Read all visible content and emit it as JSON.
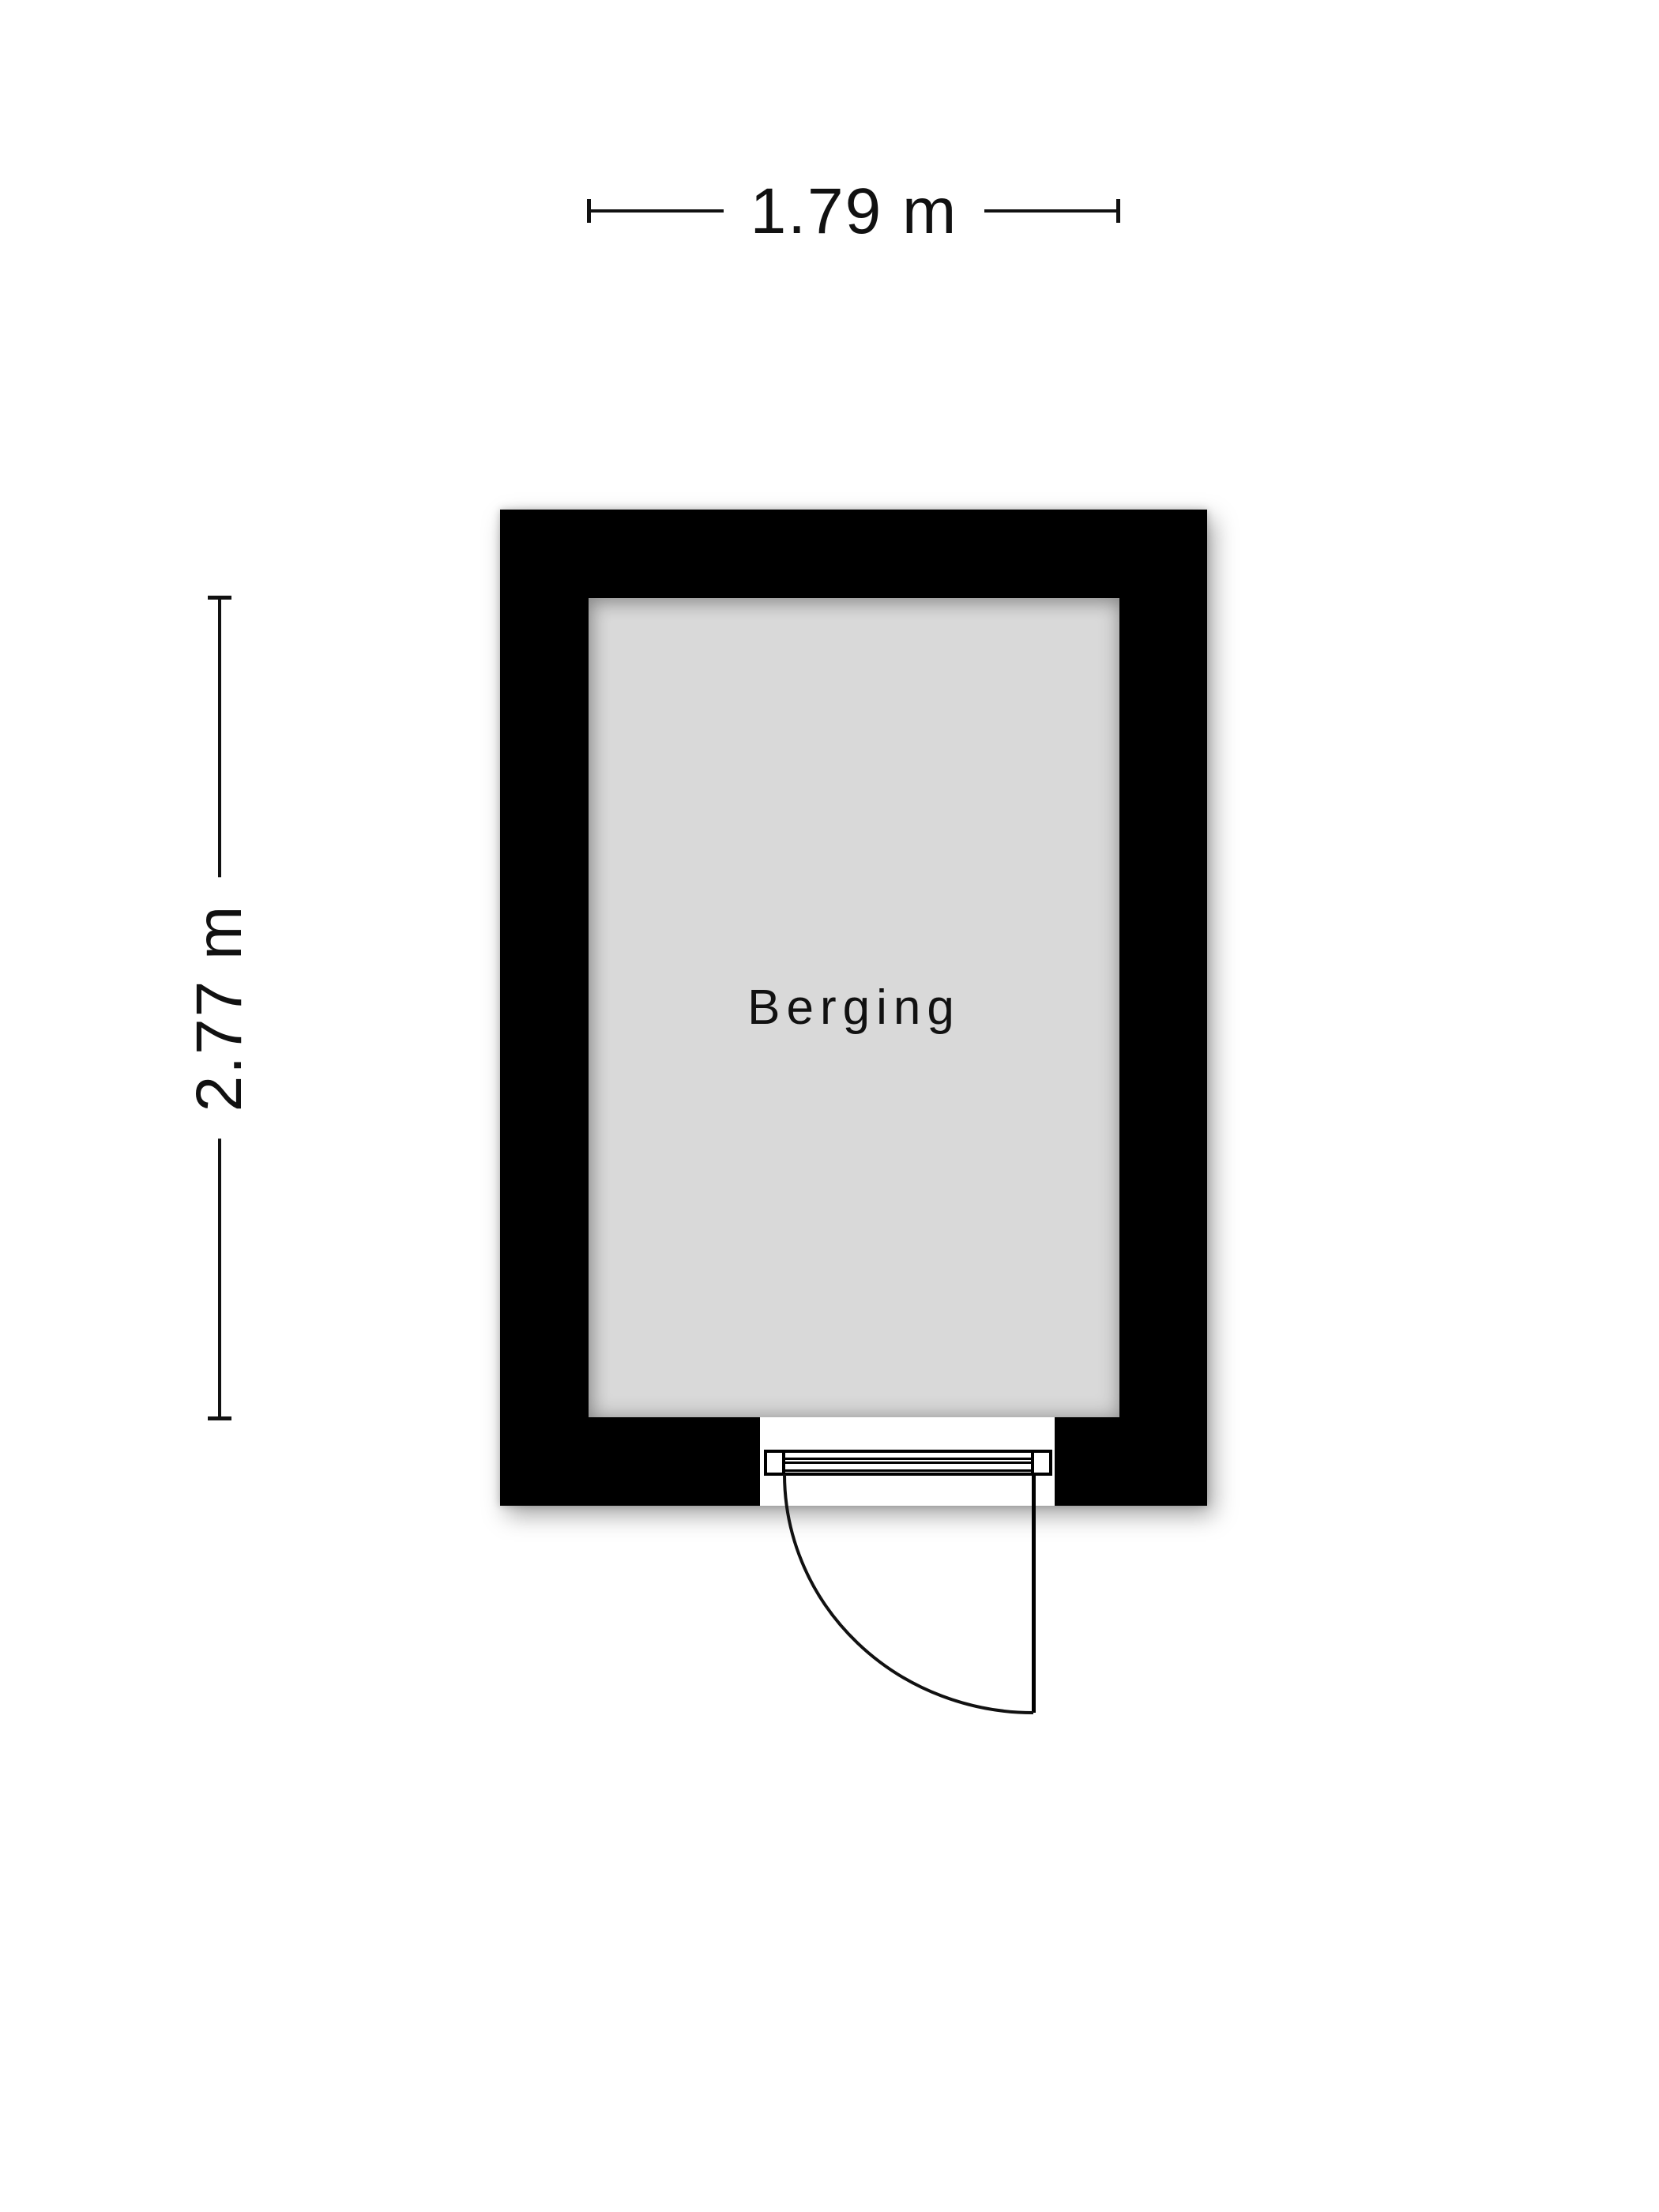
{
  "floorplan": {
    "room": {
      "label": "Berging"
    },
    "dimensions": {
      "width": {
        "label": "1.79 m"
      },
      "height": {
        "label": "2.77 m"
      }
    },
    "colors": {
      "wall": "#000000",
      "floor": "#d9d9d9",
      "background": "#ffffff",
      "ink": "#111111"
    }
  }
}
